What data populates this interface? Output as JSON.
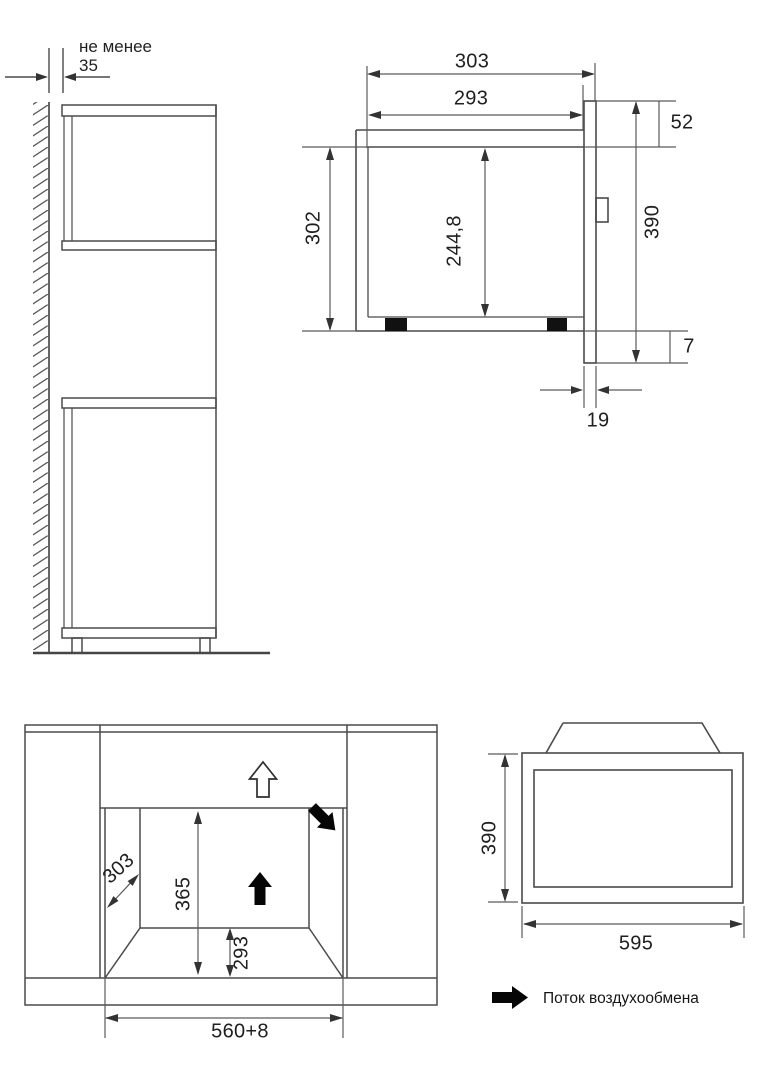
{
  "legend": {
    "airflow_label": "Поток воздухообмена"
  },
  "wall_clearance_view": {
    "note_line1": "не менее",
    "note_line2": "35"
  },
  "oven_side_view": {
    "depth_overall": "303",
    "depth_body": "293",
    "top_clearance": "52",
    "body_height": "302",
    "inner_height": "244,8",
    "front_height": "390",
    "bottom_overhang": "7",
    "door_thickness": "19"
  },
  "niche_front_view": {
    "niche_depth": "303",
    "opening_height": "365",
    "lower_height": "293",
    "niche_width": "560+8"
  },
  "oven_front_view": {
    "front_height": "390",
    "front_width": "595"
  }
}
